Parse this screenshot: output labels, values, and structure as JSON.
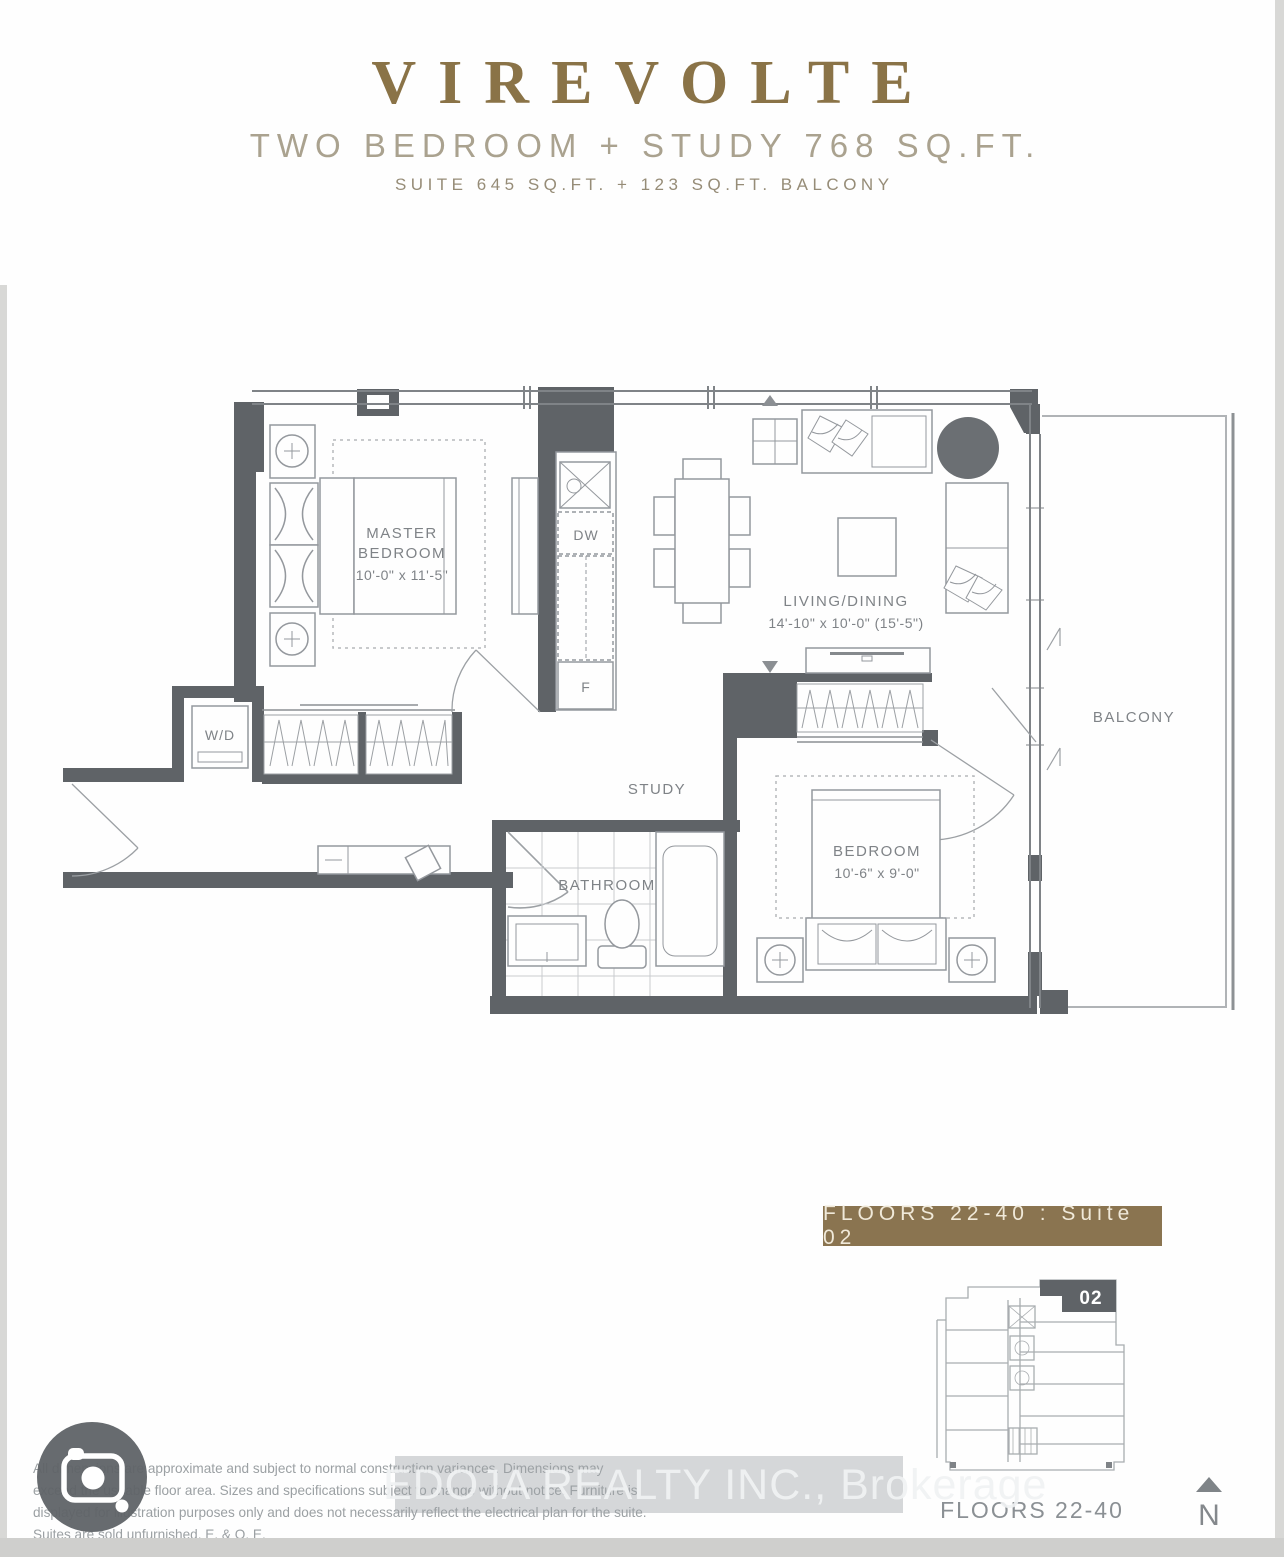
{
  "header": {
    "title": "VIREVOLTE",
    "subtitle": "TWO BEDROOM + STUDY 768 SQ.FT.",
    "suite_line": "SUITE 645 SQ.FT. + 123 SQ.FT. BALCONY"
  },
  "plan": {
    "master_bedroom": {
      "line1": "MASTER",
      "line2": "BEDROOM",
      "dims": "10'-0\" x 11'-5\""
    },
    "living_dining": {
      "name": "LIVING/DINING",
      "dims": "14'-10\" x 10'-0\" (15'-5\")"
    },
    "bedroom": {
      "name": "BEDROOM",
      "dims": "10'-6\" x 9'-0\""
    },
    "study_label": "STUDY",
    "bathroom_label": "BATHROOM",
    "balcony_label": "BALCONY",
    "laundry_label": "W/D",
    "dishwasher_label": "DW",
    "fridge_label": "F"
  },
  "floor_banner": {
    "label": "FLOORS 22-40 : Suite 02"
  },
  "key_plan": {
    "suite_number": "02",
    "caption": "FLOORS 22-40"
  },
  "compass": {
    "label": "N"
  },
  "watermark": {
    "text": "EDOJA REALTY INC., Brokerage"
  },
  "disclaimer": {
    "text": "All dimensions are approximate and subject to normal construction variances. Dimensions may exceed the useable floor area. Sizes and specifications subject to change without notice. Furniture is displayed for illustration purposes only and does not necessarily reflect the electrical plan for the suite. Suites are sold unfurnished. E. & O. E."
  },
  "colors": {
    "brand_gold": "#8a7347",
    "subtitle_tan": "#aaa28f",
    "banner_background": "#8a7450",
    "banner_text": "#f0e9d9",
    "wall_gray": "#5f6367",
    "furniture_line": "#94989d",
    "label_gray": "#7f8387"
  }
}
